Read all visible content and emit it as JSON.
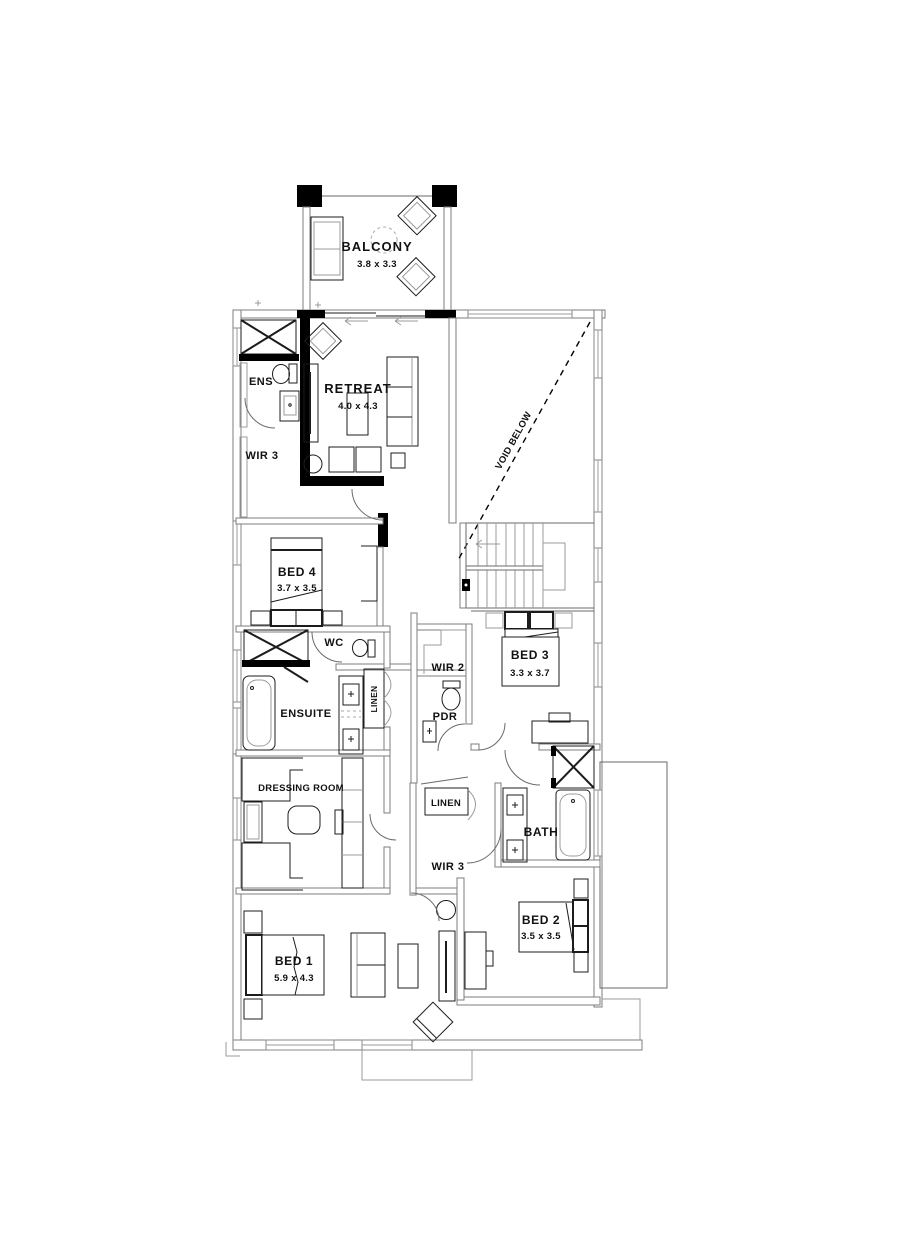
{
  "rooms": {
    "balcony": {
      "label": "BALCONY",
      "dims": "3.8 x 3.3"
    },
    "retreat": {
      "label": "RETREAT",
      "dims": "4.0 x 4.3"
    },
    "ens": {
      "label": "ENS"
    },
    "wir3_upper": {
      "label": "WIR 3"
    },
    "void": {
      "label": "VOID BELOW"
    },
    "bed4": {
      "label": "BED 4",
      "dims": "3.7 x 3.5"
    },
    "wc": {
      "label": "WC"
    },
    "ensuite": {
      "label": "ENSUITE"
    },
    "linen_ensuite": {
      "label": "LINEN"
    },
    "wir2": {
      "label": "WIR 2"
    },
    "bed3": {
      "label": "BED 3",
      "dims": "3.3 x 3.7"
    },
    "pdr": {
      "label": "PDR"
    },
    "dressing": {
      "label": "DRESSING ROOM"
    },
    "linen_hall": {
      "label": "LINEN"
    },
    "wir3_lower": {
      "label": "WIR 3"
    },
    "bath": {
      "label": "BATH"
    },
    "bed2": {
      "label": "BED 2",
      "dims": "3.5 x 3.5"
    },
    "bed1": {
      "label": "BED 1",
      "dims": "5.9 x 4.3"
    }
  },
  "colors": {
    "wall": "#000000",
    "line": "#1c1c1c",
    "light_line": "#9b9b9b",
    "background": "#ffffff"
  }
}
